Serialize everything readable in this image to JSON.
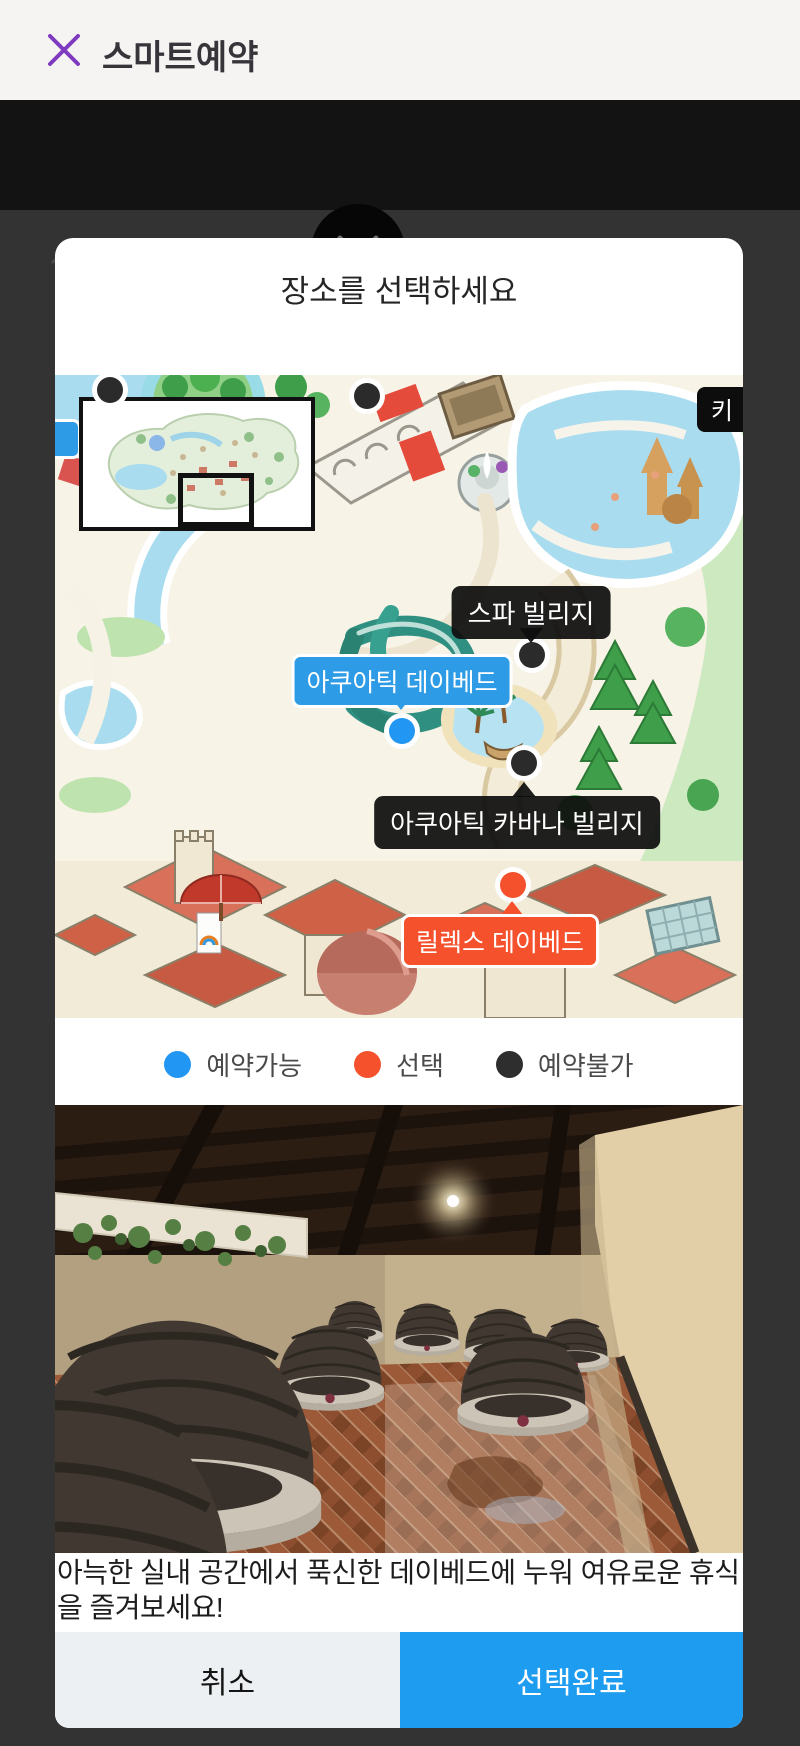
{
  "header": {
    "title": "스마트예약"
  },
  "navbar": {
    "title": "빌리지"
  },
  "modal": {
    "title": "장소를 선택하세요",
    "map": {
      "key_badge_label": "키",
      "markers": [
        {
          "label": "스파 빌리지",
          "status": "unavailable"
        },
        {
          "label": "아쿠아틱 데이베드",
          "status": "available"
        },
        {
          "label": "아쿠아틱 카바나 빌리지",
          "status": "unavailable"
        },
        {
          "label": "릴렉스 데이베드",
          "status": "selected"
        }
      ],
      "unlabeled_markers": [
        {
          "status": "unavailable"
        },
        {
          "status": "unavailable"
        }
      ]
    },
    "legend": {
      "items": [
        {
          "label": "예약가능",
          "color": "#2196f3"
        },
        {
          "label": "선택",
          "color": "#f4512c"
        },
        {
          "label": "예약불가",
          "color": "#2e2e2e"
        }
      ]
    },
    "description": "아늑한 실내 공간에서 푹신한 데이베드에 누워 여유로운 휴식을 즐겨보세요!",
    "buttons": {
      "cancel": "취소",
      "confirm": "선택완료"
    }
  },
  "colors": {
    "close_x_purple": "#7e3bbf",
    "available_blue": "#2196f3",
    "selected_orange": "#f4512c",
    "unavailable_black": "#2e2e2e",
    "confirm_button_blue": "#1e9cf0"
  }
}
